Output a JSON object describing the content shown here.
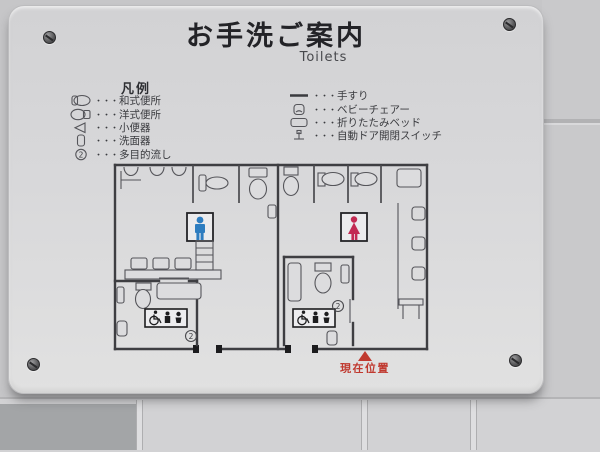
{
  "sign": {
    "title": "お手洗ご案内",
    "subtitle": "Toilets",
    "legend": {
      "heading": "凡例",
      "separator": "・・・",
      "left": [
        {
          "icon": "squat-toilet-icon",
          "label": "和式便所"
        },
        {
          "icon": "western-toilet-icon",
          "label": "洋式便所"
        },
        {
          "icon": "urinal-icon",
          "label": "小便器"
        },
        {
          "icon": "washbasin-icon",
          "label": "洗面器"
        },
        {
          "icon": "multipurpose-sink-icon",
          "label": "多目的流し"
        }
      ],
      "right": [
        {
          "icon": "handrail-icon",
          "label": "手すり"
        },
        {
          "icon": "baby-chair-icon",
          "label": "ベビーチェアー"
        },
        {
          "icon": "folding-bed-icon",
          "label": "折りたたみベッド"
        },
        {
          "icon": "auto-door-switch-icon",
          "label": "自動ドア開閉スイッチ"
        }
      ]
    },
    "map": {
      "mens_color": "#2e7dc0",
      "womens_color": "#c22a52",
      "multi_sink_mark": "2",
      "current_location_label": "現在位置",
      "marker_color": "#c0392f"
    }
  }
}
